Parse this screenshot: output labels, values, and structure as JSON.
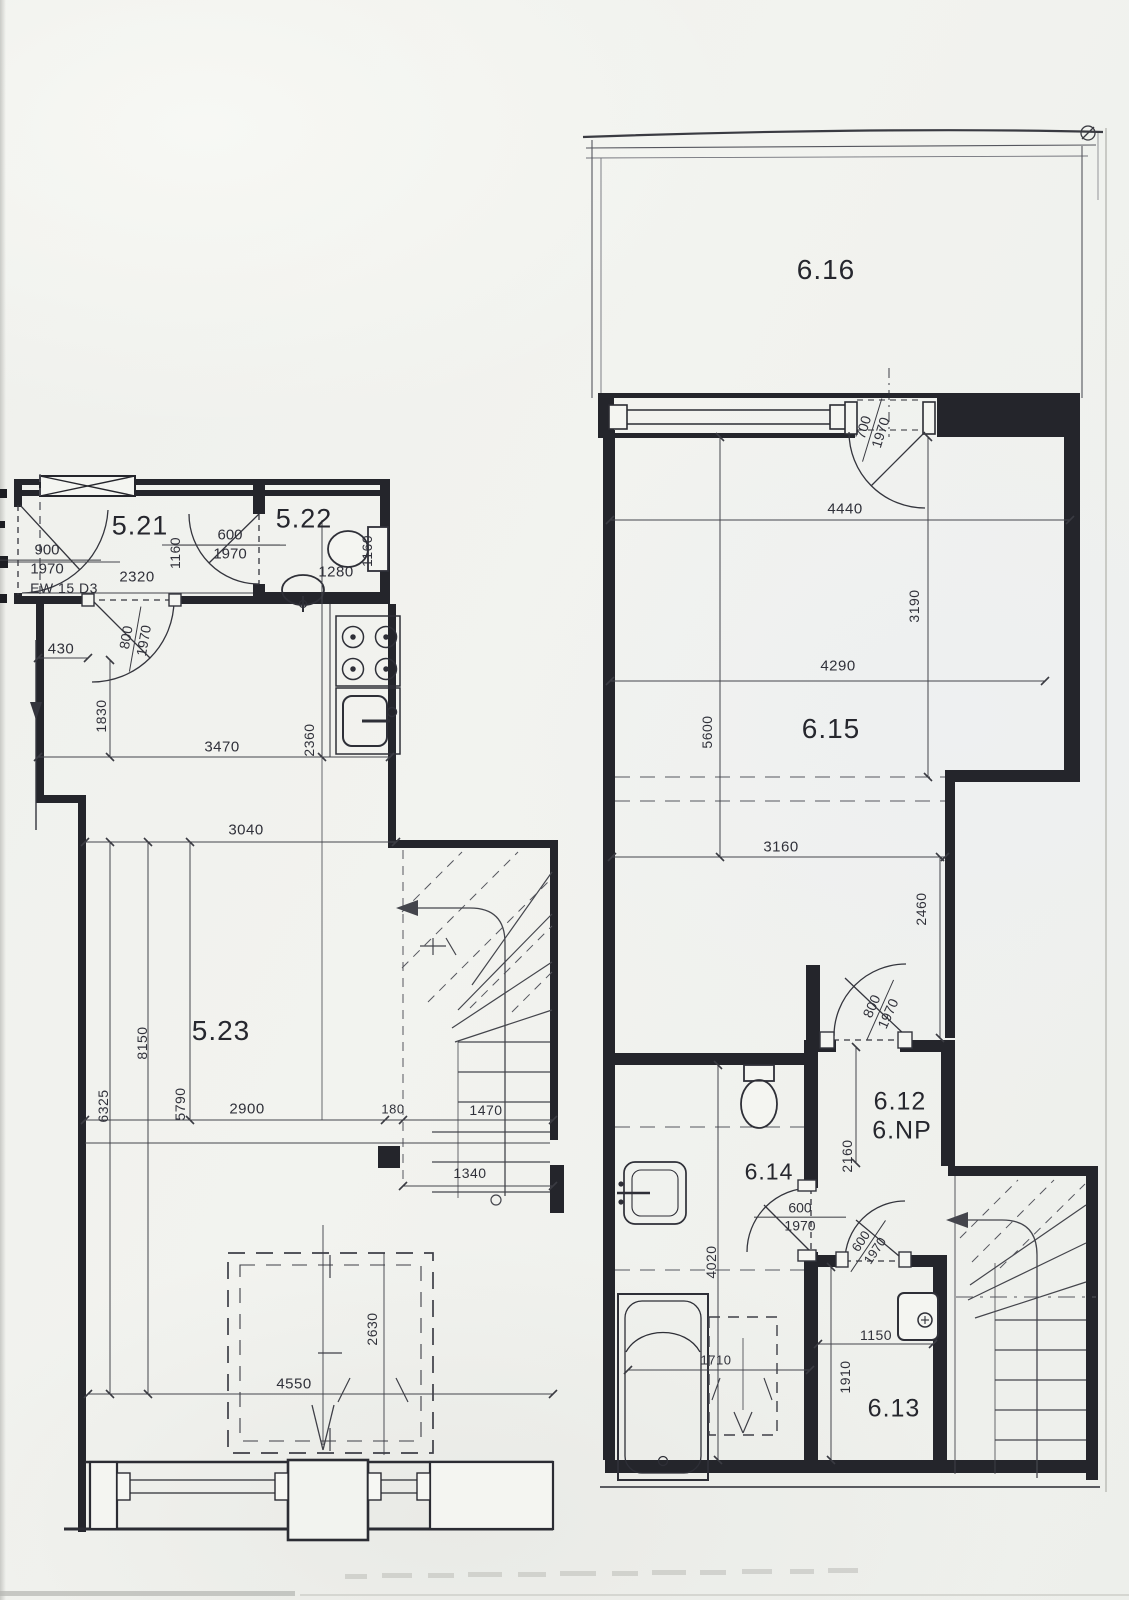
{
  "document": {
    "kind": "scanned architectural floor plan, two plan fragments",
    "left_plan_rooms": [
      "5.21",
      "5.22",
      "5.23"
    ],
    "right_plan_rooms": [
      "6.12",
      "6.13",
      "6.14",
      "6.15",
      "6.16"
    ],
    "floor_note": "6.NP",
    "colors": {
      "paper": "#f1f2ee",
      "ink": "#2b2c33",
      "wall_fill": "#24252b",
      "thin_line": "#44454c",
      "light_line": "#9a9b96"
    }
  },
  "labels": [
    {
      "name": "room-label-5-21",
      "kind": "room",
      "text": "5.21",
      "x": 140,
      "y": 526,
      "rot": 0,
      "size": 27
    },
    {
      "name": "room-label-5-22",
      "kind": "room",
      "text": "5.22",
      "x": 304,
      "y": 519,
      "rot": 0,
      "size": 27
    },
    {
      "name": "room-label-5-23",
      "kind": "room",
      "text": "5.23",
      "x": 221,
      "y": 1031,
      "rot": 0,
      "size": 28
    },
    {
      "name": "room-label-6-16",
      "kind": "room",
      "text": "6.16",
      "x": 826,
      "y": 270,
      "rot": 0,
      "size": 28
    },
    {
      "name": "room-label-6-15",
      "kind": "room",
      "text": "6.15",
      "x": 831,
      "y": 729,
      "rot": 0,
      "size": 28
    },
    {
      "name": "room-label-6-12",
      "kind": "room",
      "text": "6.12",
      "x": 900,
      "y": 1102,
      "rot": 0,
      "size": 25
    },
    {
      "name": "room-label-6-np",
      "kind": "room",
      "text": "6.NP",
      "x": 902,
      "y": 1131,
      "rot": 0,
      "size": 25
    },
    {
      "name": "room-label-6-14",
      "kind": "room",
      "text": "6.14",
      "x": 769,
      "y": 1172,
      "rot": 0,
      "size": 23
    },
    {
      "name": "room-label-6-13",
      "kind": "room",
      "text": "6.13",
      "x": 894,
      "y": 1409,
      "rot": 0,
      "size": 25
    },
    {
      "name": "door-dim-entry-521",
      "kind": "frac",
      "top": "900",
      "bottom": "1970",
      "x": 47,
      "y": 560,
      "rot": 0,
      "size": 15,
      "lineW": 108
    },
    {
      "name": "label-ew-15-d3",
      "kind": "dim",
      "text": "EW 15 D3",
      "x": 64,
      "y": 588,
      "rot": 0,
      "size": 14
    },
    {
      "name": "dim-2320",
      "kind": "dim",
      "text": "2320",
      "x": 137,
      "y": 577,
      "rot": 0,
      "size": 15
    },
    {
      "name": "dim-1160-left",
      "kind": "dimv",
      "text": "1160",
      "x": 175,
      "y": 553,
      "rot": -90,
      "size": 14
    },
    {
      "name": "door-dim-521-522",
      "kind": "frac",
      "top": "600",
      "bottom": "1970",
      "x": 230,
      "y": 545,
      "rot": 0,
      "size": 15,
      "lineW": 112
    },
    {
      "name": "dim-1280",
      "kind": "dim",
      "text": "1280",
      "x": 336,
      "y": 572,
      "rot": 0,
      "size": 15
    },
    {
      "name": "dim-1160-right",
      "kind": "dimv",
      "text": "1160",
      "x": 367,
      "y": 551,
      "rot": -90,
      "size": 14
    },
    {
      "name": "dim-430",
      "kind": "dim",
      "text": "430",
      "x": 61,
      "y": 649,
      "rot": 0,
      "size": 15
    },
    {
      "name": "door-dim-kitchen",
      "kind": "frac",
      "top": "800",
      "bottom": "1970",
      "x": 135,
      "y": 639,
      "rot": -80,
      "size": 14,
      "lineW": 66
    },
    {
      "name": "dim-1830",
      "kind": "dimv",
      "text": "1830",
      "x": 101,
      "y": 716,
      "rot": -90,
      "size": 14
    },
    {
      "name": "dim-3470",
      "kind": "dim",
      "text": "3470",
      "x": 222,
      "y": 747,
      "rot": 0,
      "size": 15
    },
    {
      "name": "dim-2360",
      "kind": "dimv",
      "text": "2360",
      "x": 309,
      "y": 740,
      "rot": -90,
      "size": 14
    },
    {
      "name": "dim-3040",
      "kind": "dim",
      "text": "3040",
      "x": 246,
      "y": 830,
      "rot": 0,
      "size": 15
    },
    {
      "name": "dim-8150",
      "kind": "dimv",
      "text": "8150",
      "x": 142,
      "y": 1043,
      "rot": -90,
      "size": 14
    },
    {
      "name": "dim-6325",
      "kind": "dimv",
      "text": "6325",
      "x": 103,
      "y": 1106,
      "rot": -90,
      "size": 14
    },
    {
      "name": "dim-5790",
      "kind": "dimv",
      "text": "5790",
      "x": 180,
      "y": 1104,
      "rot": -90,
      "size": 14
    },
    {
      "name": "dim-2900",
      "kind": "dim",
      "text": "2900",
      "x": 247,
      "y": 1109,
      "rot": 0,
      "size": 15
    },
    {
      "name": "dim-180",
      "kind": "dim",
      "text": "180",
      "x": 393,
      "y": 1109,
      "rot": 0,
      "size": 13
    },
    {
      "name": "dim-1470",
      "kind": "dim",
      "text": "1470",
      "x": 486,
      "y": 1110,
      "rot": 0,
      "size": 14
    },
    {
      "name": "dim-1340",
      "kind": "dim",
      "text": "1340",
      "x": 470,
      "y": 1173,
      "rot": 0,
      "size": 14
    },
    {
      "name": "dim-2630",
      "kind": "dimv",
      "text": "2630",
      "x": 372,
      "y": 1329,
      "rot": -90,
      "size": 14
    },
    {
      "name": "dim-4550",
      "kind": "dim",
      "text": "4550",
      "x": 294,
      "y": 1384,
      "rot": 0,
      "size": 15
    },
    {
      "name": "door-dim-616",
      "kind": "frac",
      "top": "700",
      "bottom": "1970",
      "x": 872,
      "y": 430,
      "rot": -73,
      "size": 14,
      "lineW": 66
    },
    {
      "name": "dim-4440",
      "kind": "dim",
      "text": "4440",
      "x": 845,
      "y": 509,
      "rot": 0,
      "size": 15
    },
    {
      "name": "dim-3190",
      "kind": "dimv",
      "text": "3190",
      "x": 914,
      "y": 606,
      "rot": -90,
      "size": 14
    },
    {
      "name": "dim-4290",
      "kind": "dim",
      "text": "4290",
      "x": 838,
      "y": 666,
      "rot": 0,
      "size": 15
    },
    {
      "name": "dim-5600",
      "kind": "dimv",
      "text": "5600",
      "x": 707,
      "y": 732,
      "rot": -90,
      "size": 14
    },
    {
      "name": "dim-3160",
      "kind": "dim",
      "text": "3160",
      "x": 781,
      "y": 847,
      "rot": 0,
      "size": 15
    },
    {
      "name": "dim-2460",
      "kind": "dimv",
      "text": "2460",
      "x": 921,
      "y": 909,
      "rot": -90,
      "size": 14
    },
    {
      "name": "door-dim-612",
      "kind": "frac",
      "top": "800",
      "bottom": "1970",
      "x": 880,
      "y": 1010,
      "rot": -66,
      "size": 14,
      "lineW": 66
    },
    {
      "name": "dim-2160",
      "kind": "dimv",
      "text": "2160",
      "x": 847,
      "y": 1156,
      "rot": -90,
      "size": 14
    },
    {
      "name": "door-dim-614",
      "kind": "frac",
      "top": "600",
      "bottom": "1970",
      "x": 800,
      "y": 1217,
      "rot": 0,
      "size": 14,
      "lineW": 92
    },
    {
      "name": "door-dim-613",
      "kind": "frac",
      "top": "600",
      "bottom": "1970",
      "x": 868,
      "y": 1246,
      "rot": -56,
      "size": 13,
      "lineW": 62
    },
    {
      "name": "dim-4020",
      "kind": "dimv",
      "text": "4020",
      "x": 711,
      "y": 1262,
      "rot": -90,
      "size": 14
    },
    {
      "name": "dim-1710",
      "kind": "dim",
      "text": "1710",
      "x": 716,
      "y": 1360,
      "rot": 0,
      "size": 13
    },
    {
      "name": "dim-1150",
      "kind": "dim",
      "text": "1150",
      "x": 876,
      "y": 1335,
      "rot": 0,
      "size": 14
    },
    {
      "name": "dim-1910",
      "kind": "dimv",
      "text": "1910",
      "x": 845,
      "y": 1377,
      "rot": -90,
      "size": 14
    }
  ]
}
